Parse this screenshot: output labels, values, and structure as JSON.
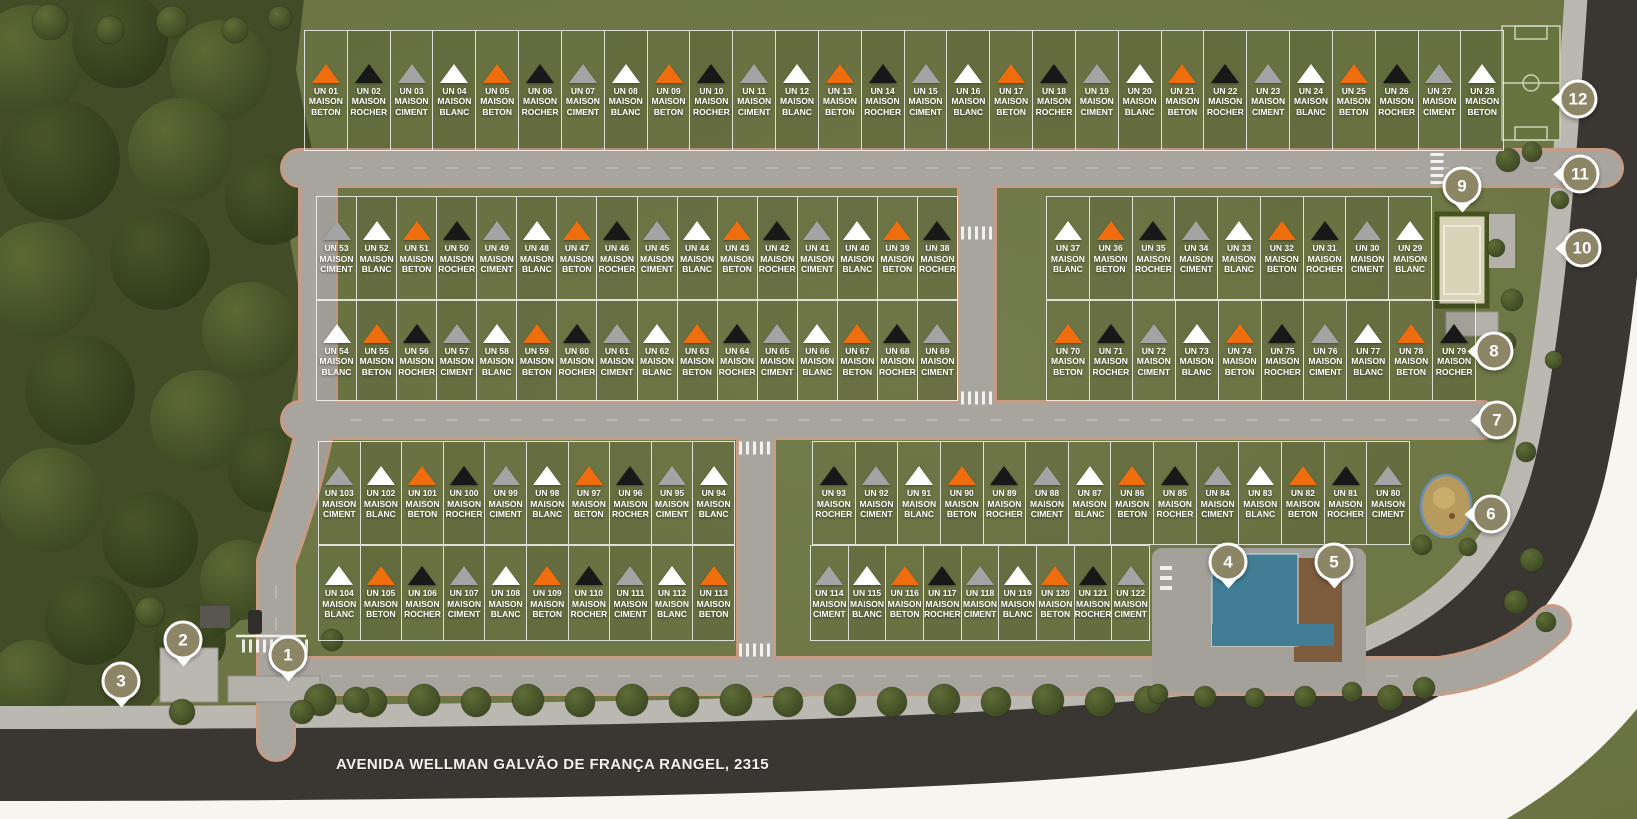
{
  "address": "AVENIDA WELLMAN GALVÃO DE FRANÇA RANGEL, 2315",
  "maison_word": "MAISON",
  "palette": {
    "orange": "#ef6d0d",
    "black": "#181818",
    "gray": "#a4a4a4",
    "white": "#ffffff"
  },
  "markers": [
    "1",
    "2",
    "3",
    "4",
    "5",
    "6",
    "7",
    "8",
    "9",
    "10",
    "11",
    "12"
  ],
  "blocks": {
    "r1": {
      "lots": [
        {
          "un": "UN 01",
          "type": "BETON",
          "marker": "orange"
        },
        {
          "un": "UN 02",
          "type": "ROCHER",
          "marker": "black"
        },
        {
          "un": "UN 03",
          "type": "CIMENT",
          "marker": "gray"
        },
        {
          "un": "UN 04",
          "type": "BLANC",
          "marker": "white"
        },
        {
          "un": "UN 05",
          "type": "BETON",
          "marker": "orange"
        },
        {
          "un": "UN 06",
          "type": "ROCHER",
          "marker": "black"
        },
        {
          "un": "UN 07",
          "type": "CIMENT",
          "marker": "gray"
        },
        {
          "un": "UN 08",
          "type": "BLANC",
          "marker": "white"
        },
        {
          "un": "UN 09",
          "type": "BETON",
          "marker": "orange"
        },
        {
          "un": "UN 10",
          "type": "ROCHER",
          "marker": "black"
        },
        {
          "un": "UN 11",
          "type": "CIMENT",
          "marker": "gray"
        },
        {
          "un": "UN 12",
          "type": "BLANC",
          "marker": "white"
        },
        {
          "un": "UN 13",
          "type": "BETON",
          "marker": "orange"
        },
        {
          "un": "UN 14",
          "type": "ROCHER",
          "marker": "black"
        },
        {
          "un": "UN 15",
          "type": "CIMENT",
          "marker": "gray"
        },
        {
          "un": "UN 16",
          "type": "BLANC",
          "marker": "white"
        },
        {
          "un": "UN 17",
          "type": "BETON",
          "marker": "orange"
        },
        {
          "un": "UN 18",
          "type": "ROCHER",
          "marker": "black"
        },
        {
          "un": "UN 19",
          "type": "CIMENT",
          "marker": "gray"
        },
        {
          "un": "UN 20",
          "type": "BLANC",
          "marker": "white"
        },
        {
          "un": "UN 21",
          "type": "BETON",
          "marker": "orange"
        },
        {
          "un": "UN 22",
          "type": "ROCHER",
          "marker": "black"
        },
        {
          "un": "UN 23",
          "type": "CIMENT",
          "marker": "gray"
        },
        {
          "un": "UN 24",
          "type": "BLANC",
          "marker": "white"
        },
        {
          "un": "UN 25",
          "type": "BETON",
          "marker": "orange"
        },
        {
          "un": "UN 26",
          "type": "ROCHER",
          "marker": "black"
        },
        {
          "un": "UN 27",
          "type": "CIMENT",
          "marker": "gray"
        },
        {
          "un": "UN 28",
          "type": "BETON",
          "marker": "white"
        }
      ]
    },
    "r2l": {
      "lots": [
        {
          "un": "UN 53",
          "type": "CIMENT",
          "marker": "gray"
        },
        {
          "un": "UN 52",
          "type": "BLANC",
          "marker": "white"
        },
        {
          "un": "UN 51",
          "type": "BETON",
          "marker": "orange"
        },
        {
          "un": "UN 50",
          "type": "ROCHER",
          "marker": "black"
        },
        {
          "un": "UN 49",
          "type": "CIMENT",
          "marker": "gray"
        },
        {
          "un": "UN 48",
          "type": "BLANC",
          "marker": "white"
        },
        {
          "un": "UN 47",
          "type": "BETON",
          "marker": "orange"
        },
        {
          "un": "UN 46",
          "type": "ROCHER",
          "marker": "black"
        },
        {
          "un": "UN 45",
          "type": "CIMENT",
          "marker": "gray"
        },
        {
          "un": "UN 44",
          "type": "BLANC",
          "marker": "white"
        },
        {
          "un": "UN 43",
          "type": "BETON",
          "marker": "orange"
        },
        {
          "un": "UN 42",
          "type": "ROCHER",
          "marker": "black"
        },
        {
          "un": "UN 41",
          "type": "CIMENT",
          "marker": "gray"
        },
        {
          "un": "UN 40",
          "type": "BLANC",
          "marker": "white"
        },
        {
          "un": "UN 39",
          "type": "BETON",
          "marker": "orange"
        },
        {
          "un": "UN 38",
          "type": "ROCHER",
          "marker": "black"
        }
      ]
    },
    "r2r": {
      "lots": [
        {
          "un": "UN 37",
          "type": "BLANC",
          "marker": "white"
        },
        {
          "un": "UN 36",
          "type": "BETON",
          "marker": "orange"
        },
        {
          "un": "UN 35",
          "type": "ROCHER",
          "marker": "black"
        },
        {
          "un": "UN 34",
          "type": "CIMENT",
          "marker": "gray"
        },
        {
          "un": "UN 33",
          "type": "BLANC",
          "marker": "white"
        },
        {
          "un": "UN 32",
          "type": "BETON",
          "marker": "orange"
        },
        {
          "un": "UN 31",
          "type": "ROCHER",
          "marker": "black"
        },
        {
          "un": "UN 30",
          "type": "CIMENT",
          "marker": "gray"
        },
        {
          "un": "UN 29",
          "type": "BLANC",
          "marker": "white"
        }
      ]
    },
    "r3l": {
      "lots": [
        {
          "un": "UN 54",
          "type": "BLANC",
          "marker": "white"
        },
        {
          "un": "UN 55",
          "type": "BETON",
          "marker": "orange"
        },
        {
          "un": "UN 56",
          "type": "ROCHER",
          "marker": "black"
        },
        {
          "un": "UN 57",
          "type": "CIMENT",
          "marker": "gray"
        },
        {
          "un": "UN 58",
          "type": "BLANC",
          "marker": "white"
        },
        {
          "un": "UN 59",
          "type": "BETON",
          "marker": "orange"
        },
        {
          "un": "UN 60",
          "type": "ROCHER",
          "marker": "black"
        },
        {
          "un": "UN 61",
          "type": "CIMENT",
          "marker": "gray"
        },
        {
          "un": "UN 62",
          "type": "BLANC",
          "marker": "white"
        },
        {
          "un": "UN 63",
          "type": "BETON",
          "marker": "orange"
        },
        {
          "un": "UN 64",
          "type": "ROCHER",
          "marker": "black"
        },
        {
          "un": "UN 65",
          "type": "CIMENT",
          "marker": "gray"
        },
        {
          "un": "UN 66",
          "type": "BLANC",
          "marker": "white"
        },
        {
          "un": "UN 67",
          "type": "BETON",
          "marker": "orange"
        },
        {
          "un": "UN 68",
          "type": "ROCHER",
          "marker": "black"
        },
        {
          "un": "UN 69",
          "type": "CIMENT",
          "marker": "gray"
        }
      ]
    },
    "r3r": {
      "lots": [
        {
          "un": "UN 70",
          "type": "BETON",
          "marker": "orange"
        },
        {
          "un": "UN 71",
          "type": "ROCHER",
          "marker": "black"
        },
        {
          "un": "UN 72",
          "type": "CIMENT",
          "marker": "gray"
        },
        {
          "un": "UN 73",
          "type": "BLANC",
          "marker": "white"
        },
        {
          "un": "UN 74",
          "type": "BETON",
          "marker": "orange"
        },
        {
          "un": "UN 75",
          "type": "ROCHER",
          "marker": "black"
        },
        {
          "un": "UN 76",
          "type": "CIMENT",
          "marker": "gray"
        },
        {
          "un": "UN 77",
          "type": "BLANC",
          "marker": "white"
        },
        {
          "un": "UN 78",
          "type": "BETON",
          "marker": "orange"
        },
        {
          "un": "UN 79",
          "type": "ROCHER",
          "marker": "black"
        }
      ]
    },
    "r4l": {
      "lots": [
        {
          "un": "UN 103",
          "type": "CIMENT",
          "marker": "gray"
        },
        {
          "un": "UN 102",
          "type": "BLANC",
          "marker": "white"
        },
        {
          "un": "UN 101",
          "type": "BETON",
          "marker": "orange"
        },
        {
          "un": "UN 100",
          "type": "ROCHER",
          "marker": "black"
        },
        {
          "un": "UN 99",
          "type": "CIMENT",
          "marker": "gray"
        },
        {
          "un": "UN 98",
          "type": "BLANC",
          "marker": "white"
        },
        {
          "un": "UN 97",
          "type": "BETON",
          "marker": "orange"
        },
        {
          "un": "UN 96",
          "type": "ROCHER",
          "marker": "black"
        },
        {
          "un": "UN 95",
          "type": "CIMENT",
          "marker": "gray"
        },
        {
          "un": "UN 94",
          "type": "BLANC",
          "marker": "white"
        }
      ]
    },
    "r4r": {
      "lots": [
        {
          "un": "UN 93",
          "type": "ROCHER",
          "marker": "black"
        },
        {
          "un": "UN 92",
          "type": "CIMENT",
          "marker": "gray"
        },
        {
          "un": "UN 91",
          "type": "BLANC",
          "marker": "white"
        },
        {
          "un": "UN 90",
          "type": "BETON",
          "marker": "orange"
        },
        {
          "un": "UN 89",
          "type": "ROCHER",
          "marker": "black"
        },
        {
          "un": "UN 88",
          "type": "CIMENT",
          "marker": "gray"
        },
        {
          "un": "UN 87",
          "type": "BLANC",
          "marker": "white"
        },
        {
          "un": "UN 86",
          "type": "BETON",
          "marker": "orange"
        },
        {
          "un": "UN 85",
          "type": "ROCHER",
          "marker": "black"
        },
        {
          "un": "UN 84",
          "type": "CIMENT",
          "marker": "gray"
        },
        {
          "un": "UN 83",
          "type": "BLANC",
          "marker": "white"
        },
        {
          "un": "UN 82",
          "type": "BETON",
          "marker": "orange"
        },
        {
          "un": "UN 81",
          "type": "ROCHER",
          "marker": "black"
        },
        {
          "un": "UN 80",
          "type": "CIMENT",
          "marker": "gray"
        }
      ]
    },
    "r5l": {
      "lots": [
        {
          "un": "UN 104",
          "type": "BLANC",
          "marker": "white"
        },
        {
          "un": "UN 105",
          "type": "BETON",
          "marker": "orange"
        },
        {
          "un": "UN 106",
          "type": "ROCHER",
          "marker": "black"
        },
        {
          "un": "UN 107",
          "type": "CIMENT",
          "marker": "gray"
        },
        {
          "un": "UN 108",
          "type": "BLANC",
          "marker": "white"
        },
        {
          "un": "UN 109",
          "type": "BETON",
          "marker": "orange"
        },
        {
          "un": "UN 110",
          "type": "ROCHER",
          "marker": "black"
        },
        {
          "un": "UN 111",
          "type": "CIMENT",
          "marker": "gray"
        },
        {
          "un": "UN 112",
          "type": "BLANC",
          "marker": "white"
        },
        {
          "un": "UN 113",
          "type": "BETON",
          "marker": "orange"
        }
      ]
    },
    "r5r": {
      "lots": [
        {
          "un": "UN 114",
          "type": "CIMENT",
          "marker": "gray"
        },
        {
          "un": "UN 115",
          "type": "BLANC",
          "marker": "white"
        },
        {
          "un": "UN 116",
          "type": "BETON",
          "marker": "orange"
        },
        {
          "un": "UN 117",
          "type": "ROCHER",
          "marker": "black"
        },
        {
          "un": "UN 118",
          "type": "CIMENT",
          "marker": "gray"
        },
        {
          "un": "UN 119",
          "type": "BLANC",
          "marker": "white"
        },
        {
          "un": "UN 120",
          "type": "BETON",
          "marker": "orange"
        },
        {
          "un": "UN 121",
          "type": "ROCHER",
          "marker": "black"
        },
        {
          "un": "UN 122",
          "type": "CIMENT",
          "marker": "gray"
        }
      ]
    }
  }
}
